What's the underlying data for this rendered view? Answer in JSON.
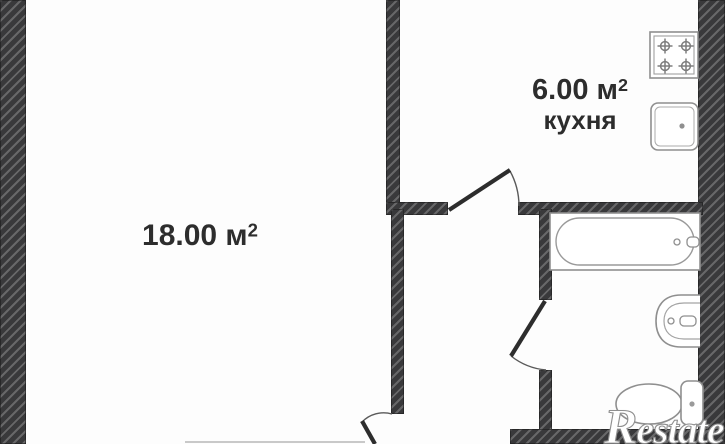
{
  "rooms": {
    "living": {
      "area": "18.00 м",
      "area_sup": "2"
    },
    "kitchen": {
      "area": "6.00 м",
      "area_sup": "2",
      "name": "кухня"
    }
  },
  "watermark": {
    "text": "Restate"
  },
  "fixtures": {
    "stove": "stove-icon",
    "kitchen_sink": "kitchen-sink-icon",
    "bathtub": "bathtub-icon",
    "washbasin": "washbasin-icon",
    "toilet": "toilet-icon"
  },
  "colors": {
    "wall": "#39393b",
    "wall_stripe": "#5d5d5f",
    "door_leaf": "#2d2d2d",
    "fixture_outline": "#8f8f8f",
    "text": "#2d2d2d",
    "watermark_fill": "#ffffff",
    "background": "#fdfdfd"
  }
}
